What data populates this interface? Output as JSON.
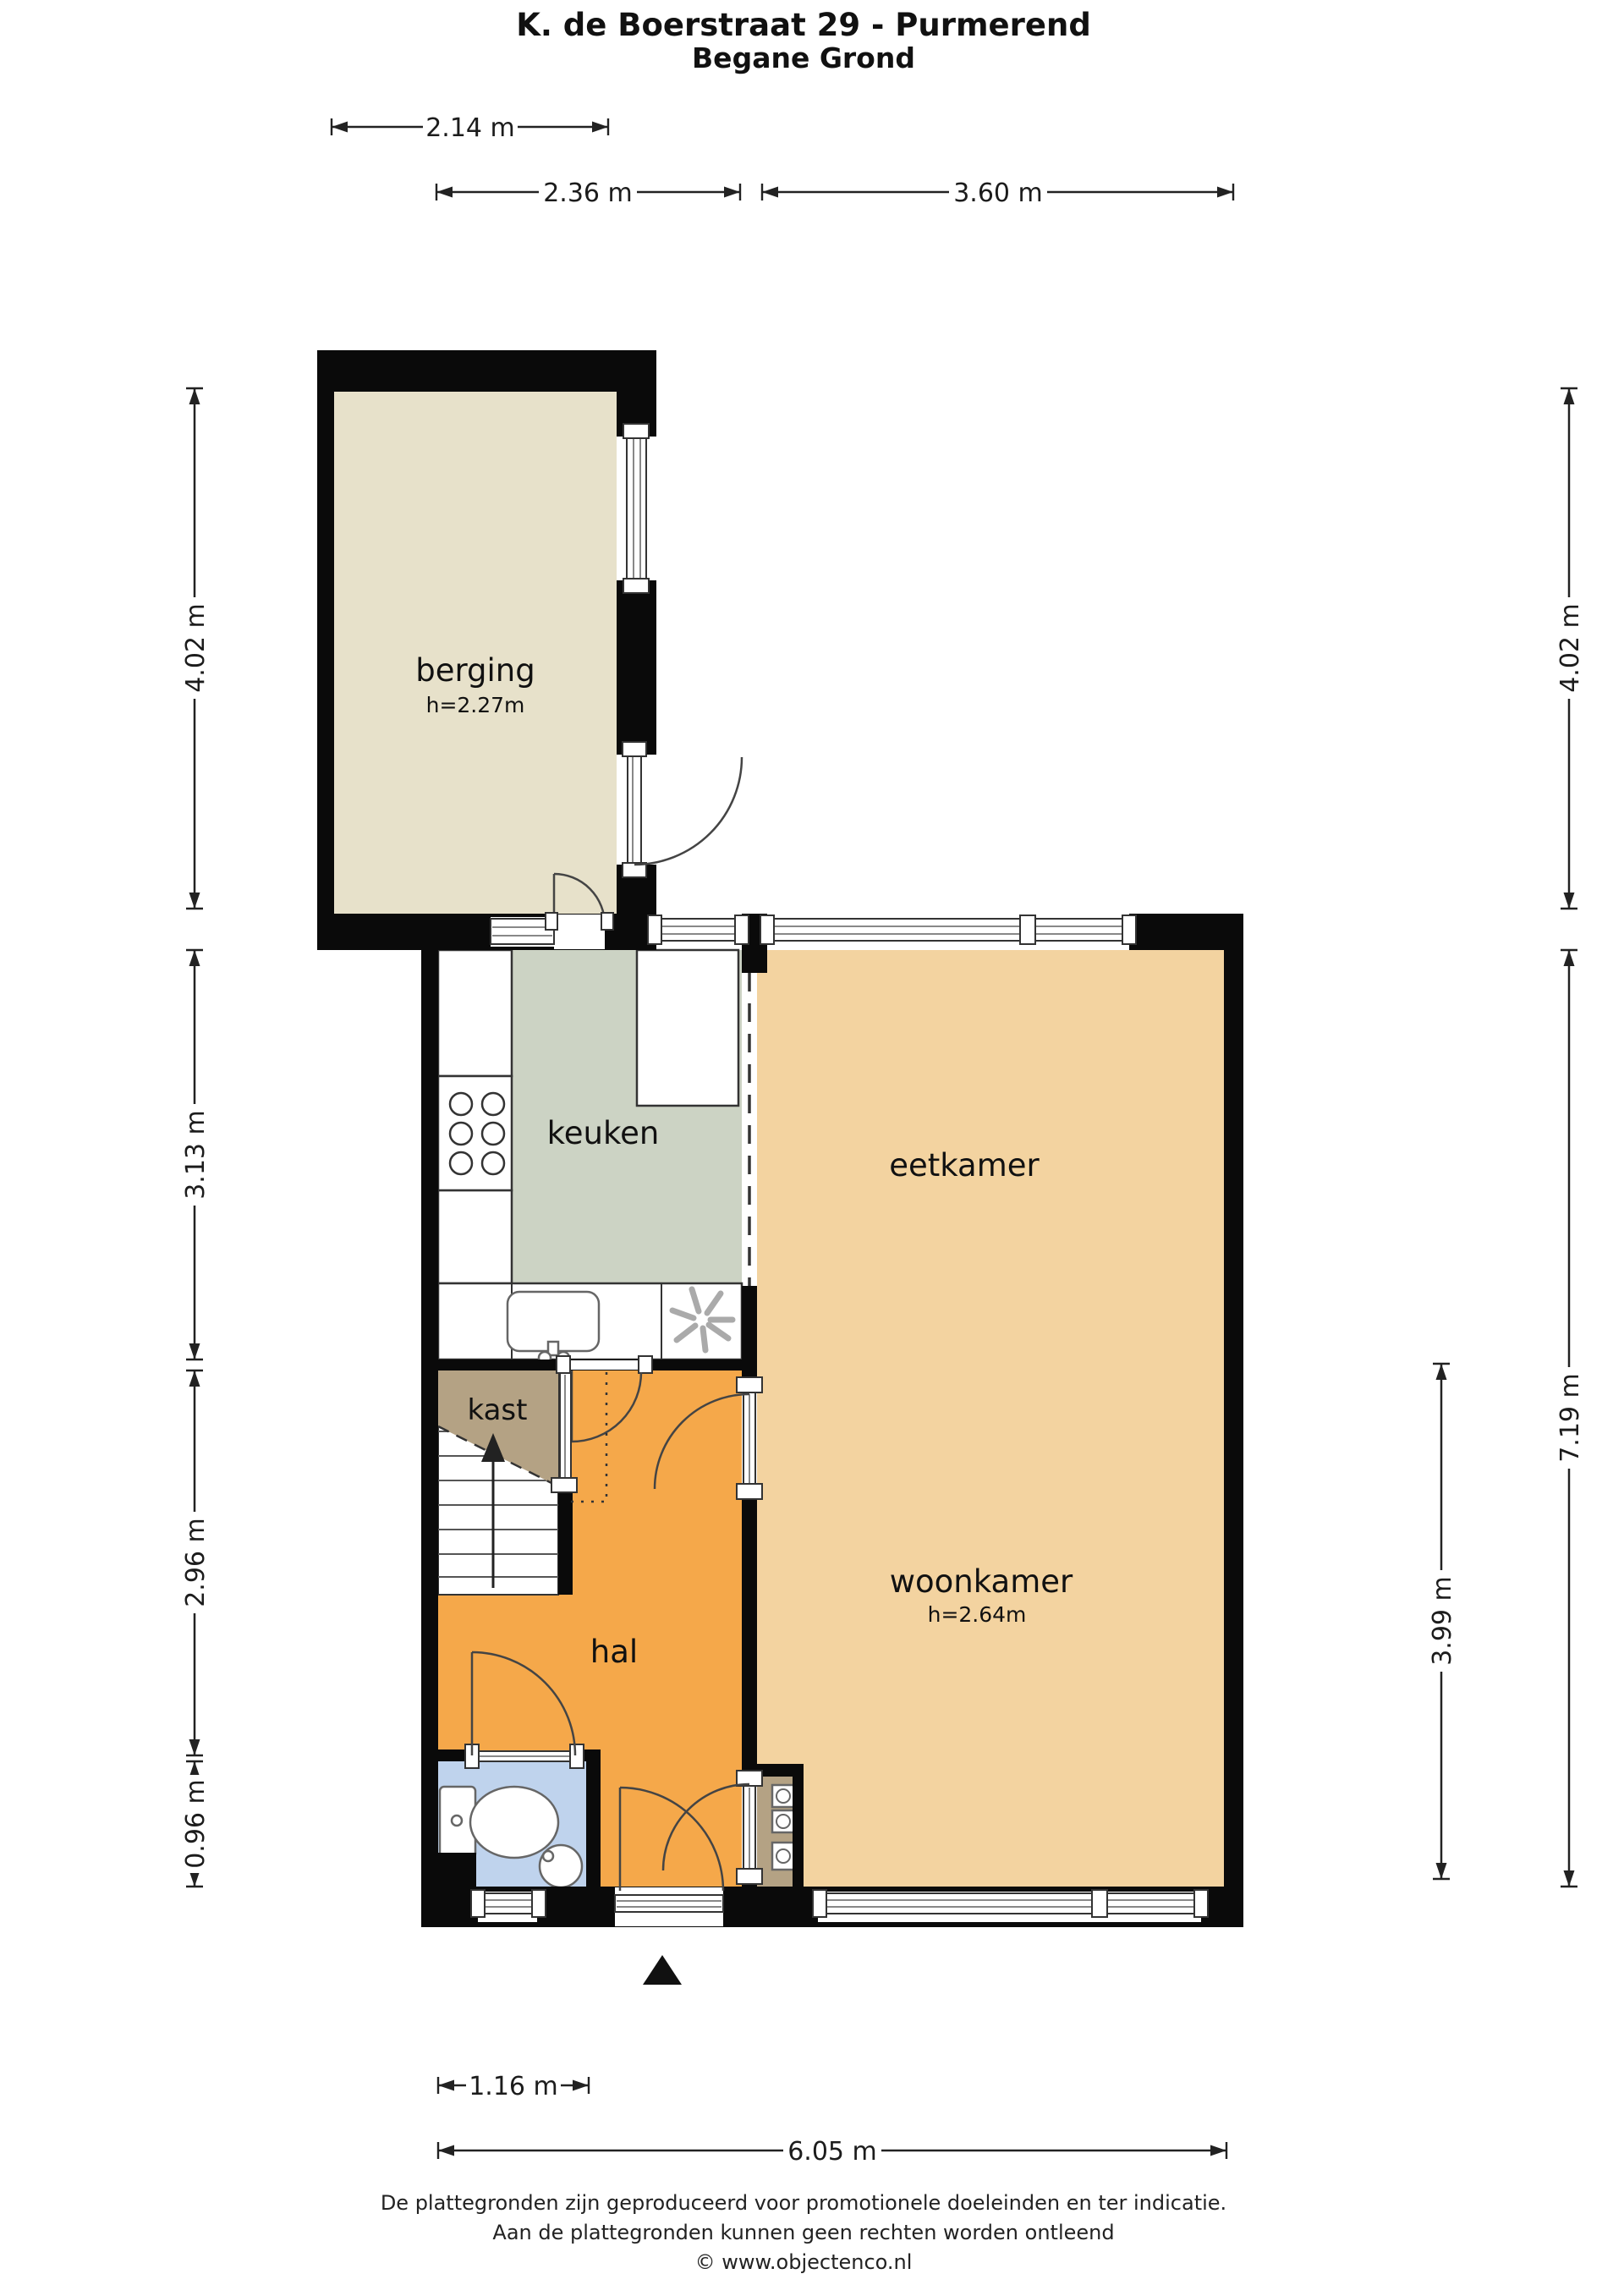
{
  "title": {
    "line1": "K. de Boerstraat 29 - Purmerend",
    "line2": "Begane Grond"
  },
  "rooms": {
    "berging": {
      "label": "berging",
      "ceiling_height": "h=2.27m"
    },
    "keuken": {
      "label": "keuken"
    },
    "eetkamer": {
      "label": "eetkamer"
    },
    "kast": {
      "label": "kast"
    },
    "hal": {
      "label": "hal"
    },
    "woonkamer": {
      "label": "woonkamer",
      "ceiling_height": "h=2.64m"
    }
  },
  "dimensions": {
    "top_berging": "2.14 m",
    "top_keuken": "2.36 m",
    "top_eetkamer": "3.60 m",
    "left_berging": "4.02 m",
    "left_keuken": "3.13 m",
    "left_hal": "2.96 m",
    "left_toilet": "0.96 m",
    "right_berging": "4.02 m",
    "right_house": "7.19 m",
    "right_woonkamer": "3.99 m",
    "bottom_entry": "1.16 m",
    "bottom_house": "6.05 m"
  },
  "footer": {
    "line1": "De plattegronden zijn geproduceerd voor promotionele doeleinden en ter indicatie.",
    "line2": "Aan de plattegronden kunnen geen rechten worden ontleend",
    "line3": "© www.objectenco.nl"
  },
  "colors": {
    "wall": "#0a0a0a",
    "berging": "#e7e1ca",
    "keuken": "#ccd3c4",
    "living": "#f3d3a0",
    "hal": "#f5a84a",
    "closet": "#b4a284",
    "toilet": "#bfd3ed"
  }
}
